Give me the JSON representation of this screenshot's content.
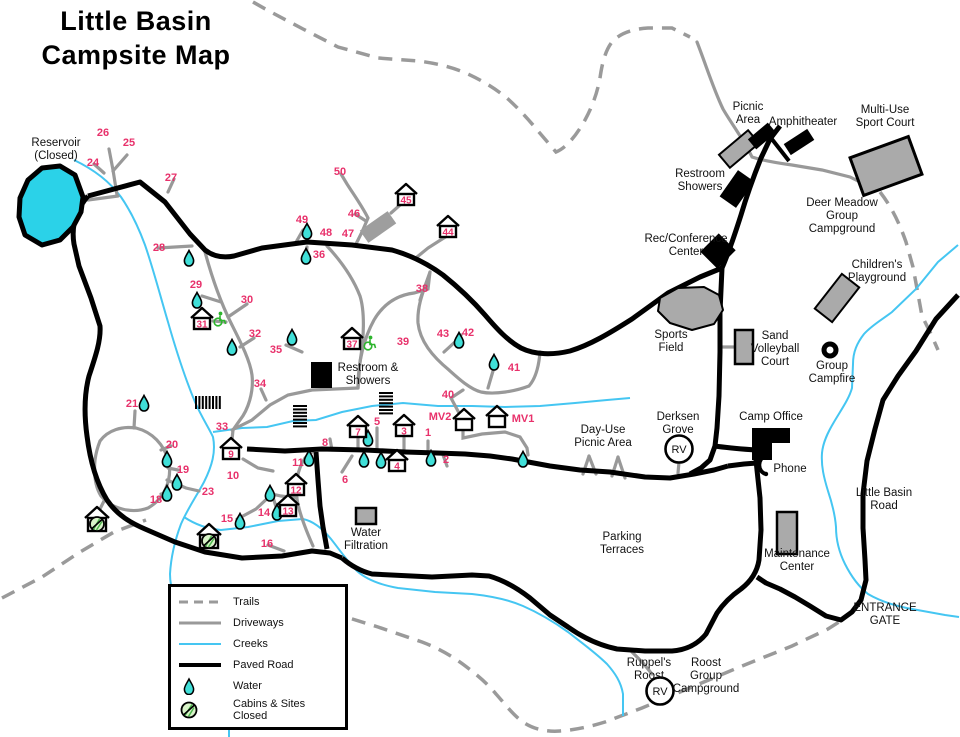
{
  "title": {
    "line1": "Little Basin",
    "line2": "Campsite Map"
  },
  "colors": {
    "site_number": "#e8316b",
    "water_fill": "#40dfd8",
    "reservoir_fill": "#2bd2e8",
    "creek": "#45c6f2",
    "driveway": "#999999",
    "trail": "#9a9a9a",
    "paved": "#000000",
    "structure_gray": "#aaaaaa",
    "structure_mid": "#9e9e9e",
    "closed_fill": "#d9f3c9",
    "closed_hatch": "#4db84d",
    "wheelchair": "#2db52d",
    "label": "#111111"
  },
  "legend": {
    "items": [
      {
        "key": "trails",
        "label": "Trails"
      },
      {
        "key": "driveways",
        "label": "Driveways"
      },
      {
        "key": "creeks",
        "label": "Creeks"
      },
      {
        "key": "paved-road",
        "label": "Paved Road"
      },
      {
        "key": "water",
        "label": "Water"
      },
      {
        "key": "cabins-closed",
        "label": "Cabins & Sites Closed"
      }
    ]
  },
  "sites": [
    {
      "n": "1",
      "x": 428,
      "y": 432
    },
    {
      "n": "2",
      "x": 446,
      "y": 459
    },
    {
      "n": "5",
      "x": 377,
      "y": 421
    },
    {
      "n": "6",
      "x": 345,
      "y": 479
    },
    {
      "n": "8",
      "x": 325,
      "y": 442
    },
    {
      "n": "10",
      "x": 233,
      "y": 475
    },
    {
      "n": "11",
      "x": 298,
      "y": 462
    },
    {
      "n": "14",
      "x": 264,
      "y": 512
    },
    {
      "n": "15",
      "x": 227,
      "y": 518
    },
    {
      "n": "16",
      "x": 267,
      "y": 543
    },
    {
      "n": "18",
      "x": 156,
      "y": 499
    },
    {
      "n": "19",
      "x": 183,
      "y": 469
    },
    {
      "n": "20",
      "x": 172,
      "y": 444
    },
    {
      "n": "21",
      "x": 132,
      "y": 403
    },
    {
      "n": "23",
      "x": 208,
      "y": 491
    },
    {
      "n": "24",
      "x": 93,
      "y": 162
    },
    {
      "n": "25",
      "x": 129,
      "y": 142
    },
    {
      "n": "26",
      "x": 103,
      "y": 132
    },
    {
      "n": "27",
      "x": 171,
      "y": 177
    },
    {
      "n": "28",
      "x": 159,
      "y": 247
    },
    {
      "n": "29",
      "x": 196,
      "y": 284
    },
    {
      "n": "30",
      "x": 247,
      "y": 299
    },
    {
      "n": "32",
      "x": 255,
      "y": 333
    },
    {
      "n": "33",
      "x": 222,
      "y": 426
    },
    {
      "n": "34",
      "x": 260,
      "y": 383
    },
    {
      "n": "35",
      "x": 276,
      "y": 349
    },
    {
      "n": "36",
      "x": 319,
      "y": 254
    },
    {
      "n": "38",
      "x": 422,
      "y": 288
    },
    {
      "n": "39",
      "x": 403,
      "y": 341
    },
    {
      "n": "40",
      "x": 448,
      "y": 394
    },
    {
      "n": "41",
      "x": 514,
      "y": 367
    },
    {
      "n": "42",
      "x": 468,
      "y": 332
    },
    {
      "n": "43",
      "x": 443,
      "y": 333
    },
    {
      "n": "46",
      "x": 354,
      "y": 213
    },
    {
      "n": "47",
      "x": 348,
      "y": 233
    },
    {
      "n": "48",
      "x": 326,
      "y": 232
    },
    {
      "n": "49",
      "x": 302,
      "y": 219
    },
    {
      "n": "50",
      "x": 340,
      "y": 171
    },
    {
      "n": "MV1",
      "x": 523,
      "y": 418
    },
    {
      "n": "MV2",
      "x": 440,
      "y": 416
    }
  ],
  "cabins": [
    {
      "n": "3",
      "x": 404,
      "y": 427
    },
    {
      "n": "4",
      "x": 397,
      "y": 462
    },
    {
      "n": "7",
      "x": 358,
      "y": 428
    },
    {
      "n": "9",
      "x": 231,
      "y": 450
    },
    {
      "n": "12",
      "x": 296,
      "y": 486
    },
    {
      "n": "13",
      "x": 288,
      "y": 507
    },
    {
      "n": "31",
      "x": 202,
      "y": 320
    },
    {
      "n": "37",
      "x": 352,
      "y": 340
    },
    {
      "n": "44",
      "x": 448,
      "y": 228
    },
    {
      "n": "45",
      "x": 406,
      "y": 196
    },
    {
      "n": "",
      "x": 464,
      "y": 421
    },
    {
      "n": "",
      "x": 497,
      "y": 418
    }
  ],
  "closed_cabins": [
    {
      "x": 97,
      "y": 520
    },
    {
      "x": 209,
      "y": 537
    }
  ],
  "wheelchair_icons": [
    {
      "x": 219,
      "y": 318
    },
    {
      "x": 369,
      "y": 342
    }
  ],
  "water_drops": [
    [
      144,
      402
    ],
    [
      167,
      458
    ],
    [
      177,
      481
    ],
    [
      167,
      492
    ],
    [
      309,
      457
    ],
    [
      270,
      492
    ],
    [
      277,
      511
    ],
    [
      240,
      520
    ],
    [
      364,
      458
    ],
    [
      381,
      459
    ],
    [
      368,
      437
    ],
    [
      431,
      457
    ],
    [
      523,
      458
    ],
    [
      189,
      257
    ],
    [
      197,
      299
    ],
    [
      232,
      346
    ],
    [
      292,
      336
    ],
    [
      307,
      230
    ],
    [
      306,
      255
    ],
    [
      459,
      339
    ],
    [
      494,
      361
    ]
  ],
  "stairs_icons": [
    {
      "x": 196,
      "y": 396,
      "w": 24,
      "h": 13,
      "dir": "v"
    },
    {
      "x": 293,
      "y": 406,
      "w": 14,
      "h": 23,
      "dir": "h"
    },
    {
      "x": 379,
      "y": 393,
      "w": 14,
      "h": 23,
      "dir": "h"
    }
  ],
  "rv_badges": [
    {
      "x": 679,
      "y": 449,
      "label": "RV"
    },
    {
      "x": 660,
      "y": 691,
      "label": "RV"
    }
  ],
  "phone_icon": {
    "x": 764,
    "y": 465
  },
  "labels": [
    {
      "id": "reservoir",
      "x": 56,
      "y": 146,
      "lines": [
        "Reservoir",
        "(Closed)"
      ]
    },
    {
      "id": "restroom-showers-mid",
      "x": 368,
      "y": 371,
      "lines": [
        "Restroom &",
        "Showers"
      ]
    },
    {
      "id": "water-filtration",
      "x": 366,
      "y": 536,
      "lines": [
        "Water",
        "Filtration"
      ]
    },
    {
      "id": "picnic-area",
      "x": 748,
      "y": 110,
      "lines": [
        "Picnic",
        "Area"
      ]
    },
    {
      "id": "amphitheater",
      "x": 803,
      "y": 125,
      "lines": [
        "Amphitheater"
      ]
    },
    {
      "id": "multi-use-sport-court",
      "x": 885,
      "y": 113,
      "lines": [
        "Multi-Use",
        "Sport Court"
      ]
    },
    {
      "id": "restroom-showers-top",
      "x": 700,
      "y": 177,
      "lines": [
        "Restroom",
        "Showers"
      ]
    },
    {
      "id": "deer-meadow-group-campground",
      "x": 842,
      "y": 206,
      "lines": [
        "Deer Meadow",
        "Group",
        "Campground"
      ]
    },
    {
      "id": "rec-conference-center",
      "x": 686,
      "y": 242,
      "lines": [
        "Rec/Conference",
        "Center"
      ]
    },
    {
      "id": "childrens-playground",
      "x": 877,
      "y": 268,
      "lines": [
        "Children's",
        "Playground"
      ]
    },
    {
      "id": "sports-field",
      "x": 671,
      "y": 338,
      "lines": [
        "Sports",
        "Field"
      ]
    },
    {
      "id": "sand-volleyball-court",
      "x": 775,
      "y": 339,
      "lines": [
        "Sand",
        "Volleyball",
        "Court"
      ]
    },
    {
      "id": "group-campfire",
      "x": 832,
      "y": 369,
      "lines": [
        "Group",
        "Campfire"
      ]
    },
    {
      "id": "derksen-grove",
      "x": 678,
      "y": 420,
      "lines": [
        "Derksen",
        "Grove"
      ]
    },
    {
      "id": "camp-office",
      "x": 771,
      "y": 420,
      "lines": [
        "Camp Office"
      ]
    },
    {
      "id": "phone",
      "x": 790,
      "y": 472,
      "lines": [
        "Phone"
      ]
    },
    {
      "id": "little-basin-road",
      "x": 884,
      "y": 496,
      "lines": [
        "Little Basin",
        "Road"
      ]
    },
    {
      "id": "maintenance-center",
      "x": 797,
      "y": 557,
      "lines": [
        "Maintenance",
        "Center"
      ]
    },
    {
      "id": "parking-terraces",
      "x": 622,
      "y": 540,
      "lines": [
        "Parking",
        "Terraces"
      ]
    },
    {
      "id": "day-use-picnic-area",
      "x": 603,
      "y": 433,
      "lines": [
        "Day-Use",
        "Picnic Area"
      ]
    },
    {
      "id": "entrance-gate",
      "x": 885,
      "y": 611,
      "lines": [
        "ENTRANCE",
        "GATE"
      ]
    },
    {
      "id": "ruppels-roost",
      "x": 649,
      "y": 666,
      "lines": [
        "Ruppel's",
        "Roost"
      ]
    },
    {
      "id": "roost-group-campground",
      "x": 706,
      "y": 666,
      "lines": [
        "Roost",
        "Group",
        "Campground"
      ]
    }
  ],
  "structures": [
    {
      "name": "reservoir",
      "type": "polygon",
      "points": "42,168 60,166 75,175 83,197 81,212 73,227 60,240 42,245 25,235 19,217 20,198 28,180",
      "fill": "reservoir",
      "stroke": 5
    },
    {
      "name": "picnic-shelter",
      "type": "rrect",
      "cx": 739,
      "cy": 149,
      "w": 38,
      "h": 17,
      "rot": -40,
      "fill": "gray",
      "stroke": 2
    },
    {
      "name": "picnic-structure-1",
      "type": "rrect",
      "cx": 762,
      "cy": 136,
      "w": 26,
      "h": 13,
      "rot": -40,
      "fill": "black"
    },
    {
      "name": "picnic-structure-2",
      "type": "rrect",
      "cx": 799,
      "cy": 142,
      "w": 28,
      "h": 13,
      "rot": -33,
      "fill": "black"
    },
    {
      "name": "amphitheater-stage-line",
      "type": "line",
      "x1": 764,
      "y1": 129,
      "x2": 789,
      "y2": 161,
      "w": 4
    },
    {
      "name": "restroom-showers-top-building",
      "type": "rrect",
      "cx": 737,
      "cy": 189,
      "w": 32,
      "h": 20,
      "rot": -55,
      "fill": "black"
    },
    {
      "name": "rec-conference-building",
      "type": "rrect",
      "cx": 718,
      "cy": 251,
      "w": 26,
      "h": 24,
      "rot": -45,
      "fill": "black"
    },
    {
      "name": "multi-use-sport-court-area",
      "type": "rrect",
      "cx": 886,
      "cy": 166,
      "w": 62,
      "h": 40,
      "rot": -20,
      "fill": "gray",
      "stroke": 3
    },
    {
      "name": "childrens-playground-area",
      "type": "rrect",
      "cx": 837,
      "cy": 298,
      "w": 44,
      "h": 22,
      "rot": -52,
      "fill": "gray",
      "stroke": 2
    },
    {
      "name": "sports-field-area",
      "type": "polygon",
      "points": "660,298 678,288 704,287 719,295 723,310 714,324 692,330 670,323 658,311",
      "fill": "gray",
      "stroke": 2
    },
    {
      "name": "sand-volleyball-court-area",
      "type": "rect",
      "x": 735,
      "y": 330,
      "w": 18,
      "h": 34,
      "fill": "gray",
      "stroke": 2.5
    },
    {
      "name": "maintenance-building",
      "type": "rect",
      "x": 777,
      "y": 512,
      "w": 20,
      "h": 42,
      "fill": "gray",
      "stroke": 2.5
    },
    {
      "name": "water-filtration-building",
      "type": "rect",
      "x": 356,
      "y": 508,
      "w": 20,
      "h": 16,
      "fill": "gray",
      "stroke": 2.5
    },
    {
      "name": "restroom-showers-mid-building",
      "type": "rect",
      "x": 311,
      "y": 362,
      "w": 21,
      "h": 26,
      "fill": "black"
    },
    {
      "name": "camp-office-building",
      "type": "polygon",
      "points": "752,428 790,428 790,443 772,443 772,460 752,460",
      "fill": "black"
    },
    {
      "name": "parking-lot-45",
      "type": "rrect",
      "cx": 378,
      "cy": 227,
      "w": 34,
      "h": 15,
      "rot": -35,
      "fill": "mid"
    },
    {
      "name": "group-campfire-ring",
      "type": "ring",
      "cx": 830,
      "cy": 350,
      "r": 6
    }
  ]
}
